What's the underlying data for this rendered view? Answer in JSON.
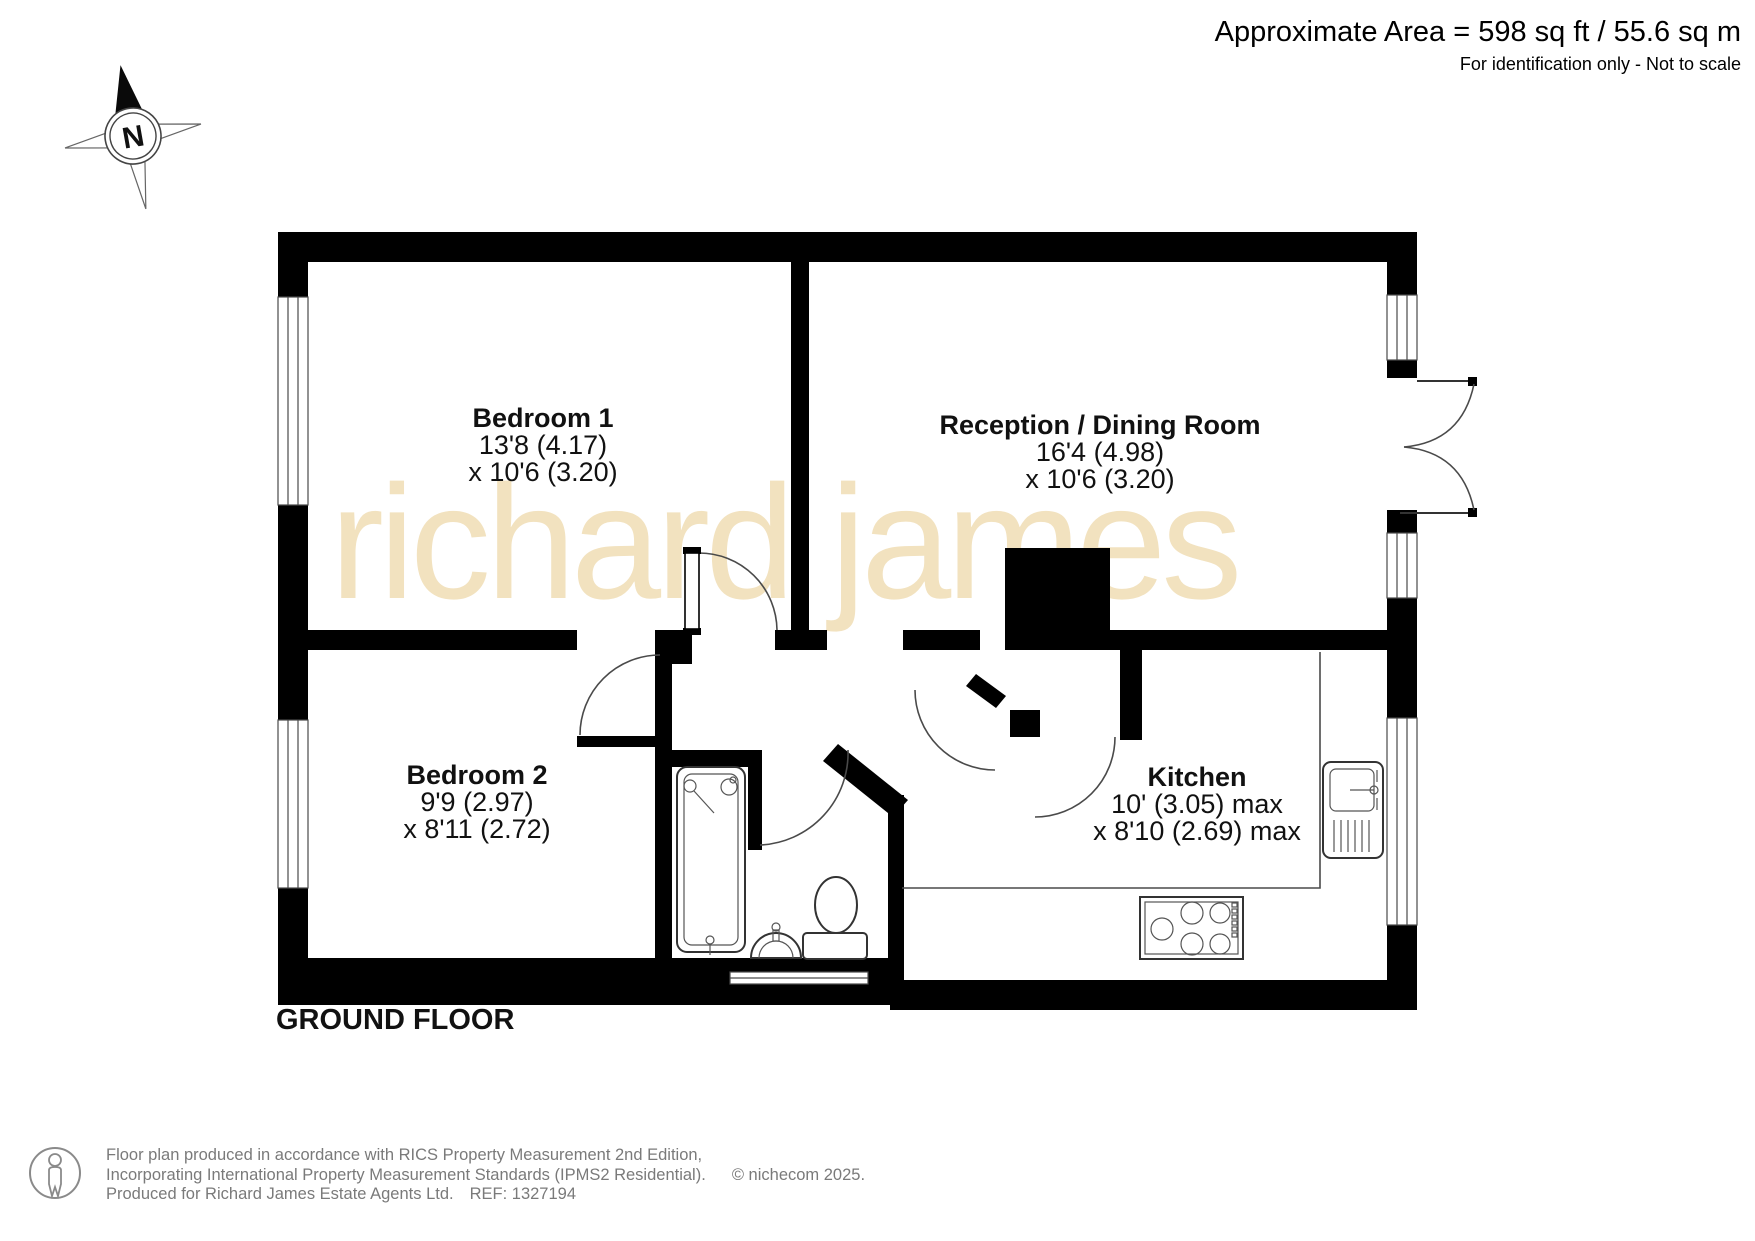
{
  "header": {
    "area_line": "Approximate Area = 598 sq ft / 55.6 sq m",
    "note_line": "For identification only - Not to scale"
  },
  "compass": {
    "label": "N"
  },
  "watermark": {
    "text": "richard james"
  },
  "floor_label": "GROUND FLOOR",
  "rooms": [
    {
      "name": "Bedroom 1",
      "dim1": "13'8 (4.17)",
      "dim2": "x 10'6 (3.20)"
    },
    {
      "name": "Reception / Dining Room",
      "dim1": "16'4 (4.98)",
      "dim2": "x 10'6 (3.20)"
    },
    {
      "name": "Bedroom 2",
      "dim1": "9'9 (2.97)",
      "dim2": "x 8'11 (2.72)"
    },
    {
      "name": "Kitchen",
      "dim1": "10' (3.05) max",
      "dim2": "x 8'10 (2.69) max"
    }
  ],
  "footer": {
    "line1": "Floor plan produced in accordance with RICS Property Measurement 2nd Edition,",
    "line2": "Incorporating International Property Measurement Standards (IPMS2 Residential).",
    "copyright": "© nichecom 2025.",
    "line3": "Produced for Richard James Estate Agents Ltd.",
    "ref": "REF: 1327194"
  },
  "icons": {
    "compass": "compass-north-icon",
    "person": "person-icon"
  },
  "colors": {
    "wall": "#000000",
    "line": "#4a4a4a",
    "text": "#111111",
    "footer": "#7a7a7a",
    "watermark": "#f2e2bf"
  }
}
